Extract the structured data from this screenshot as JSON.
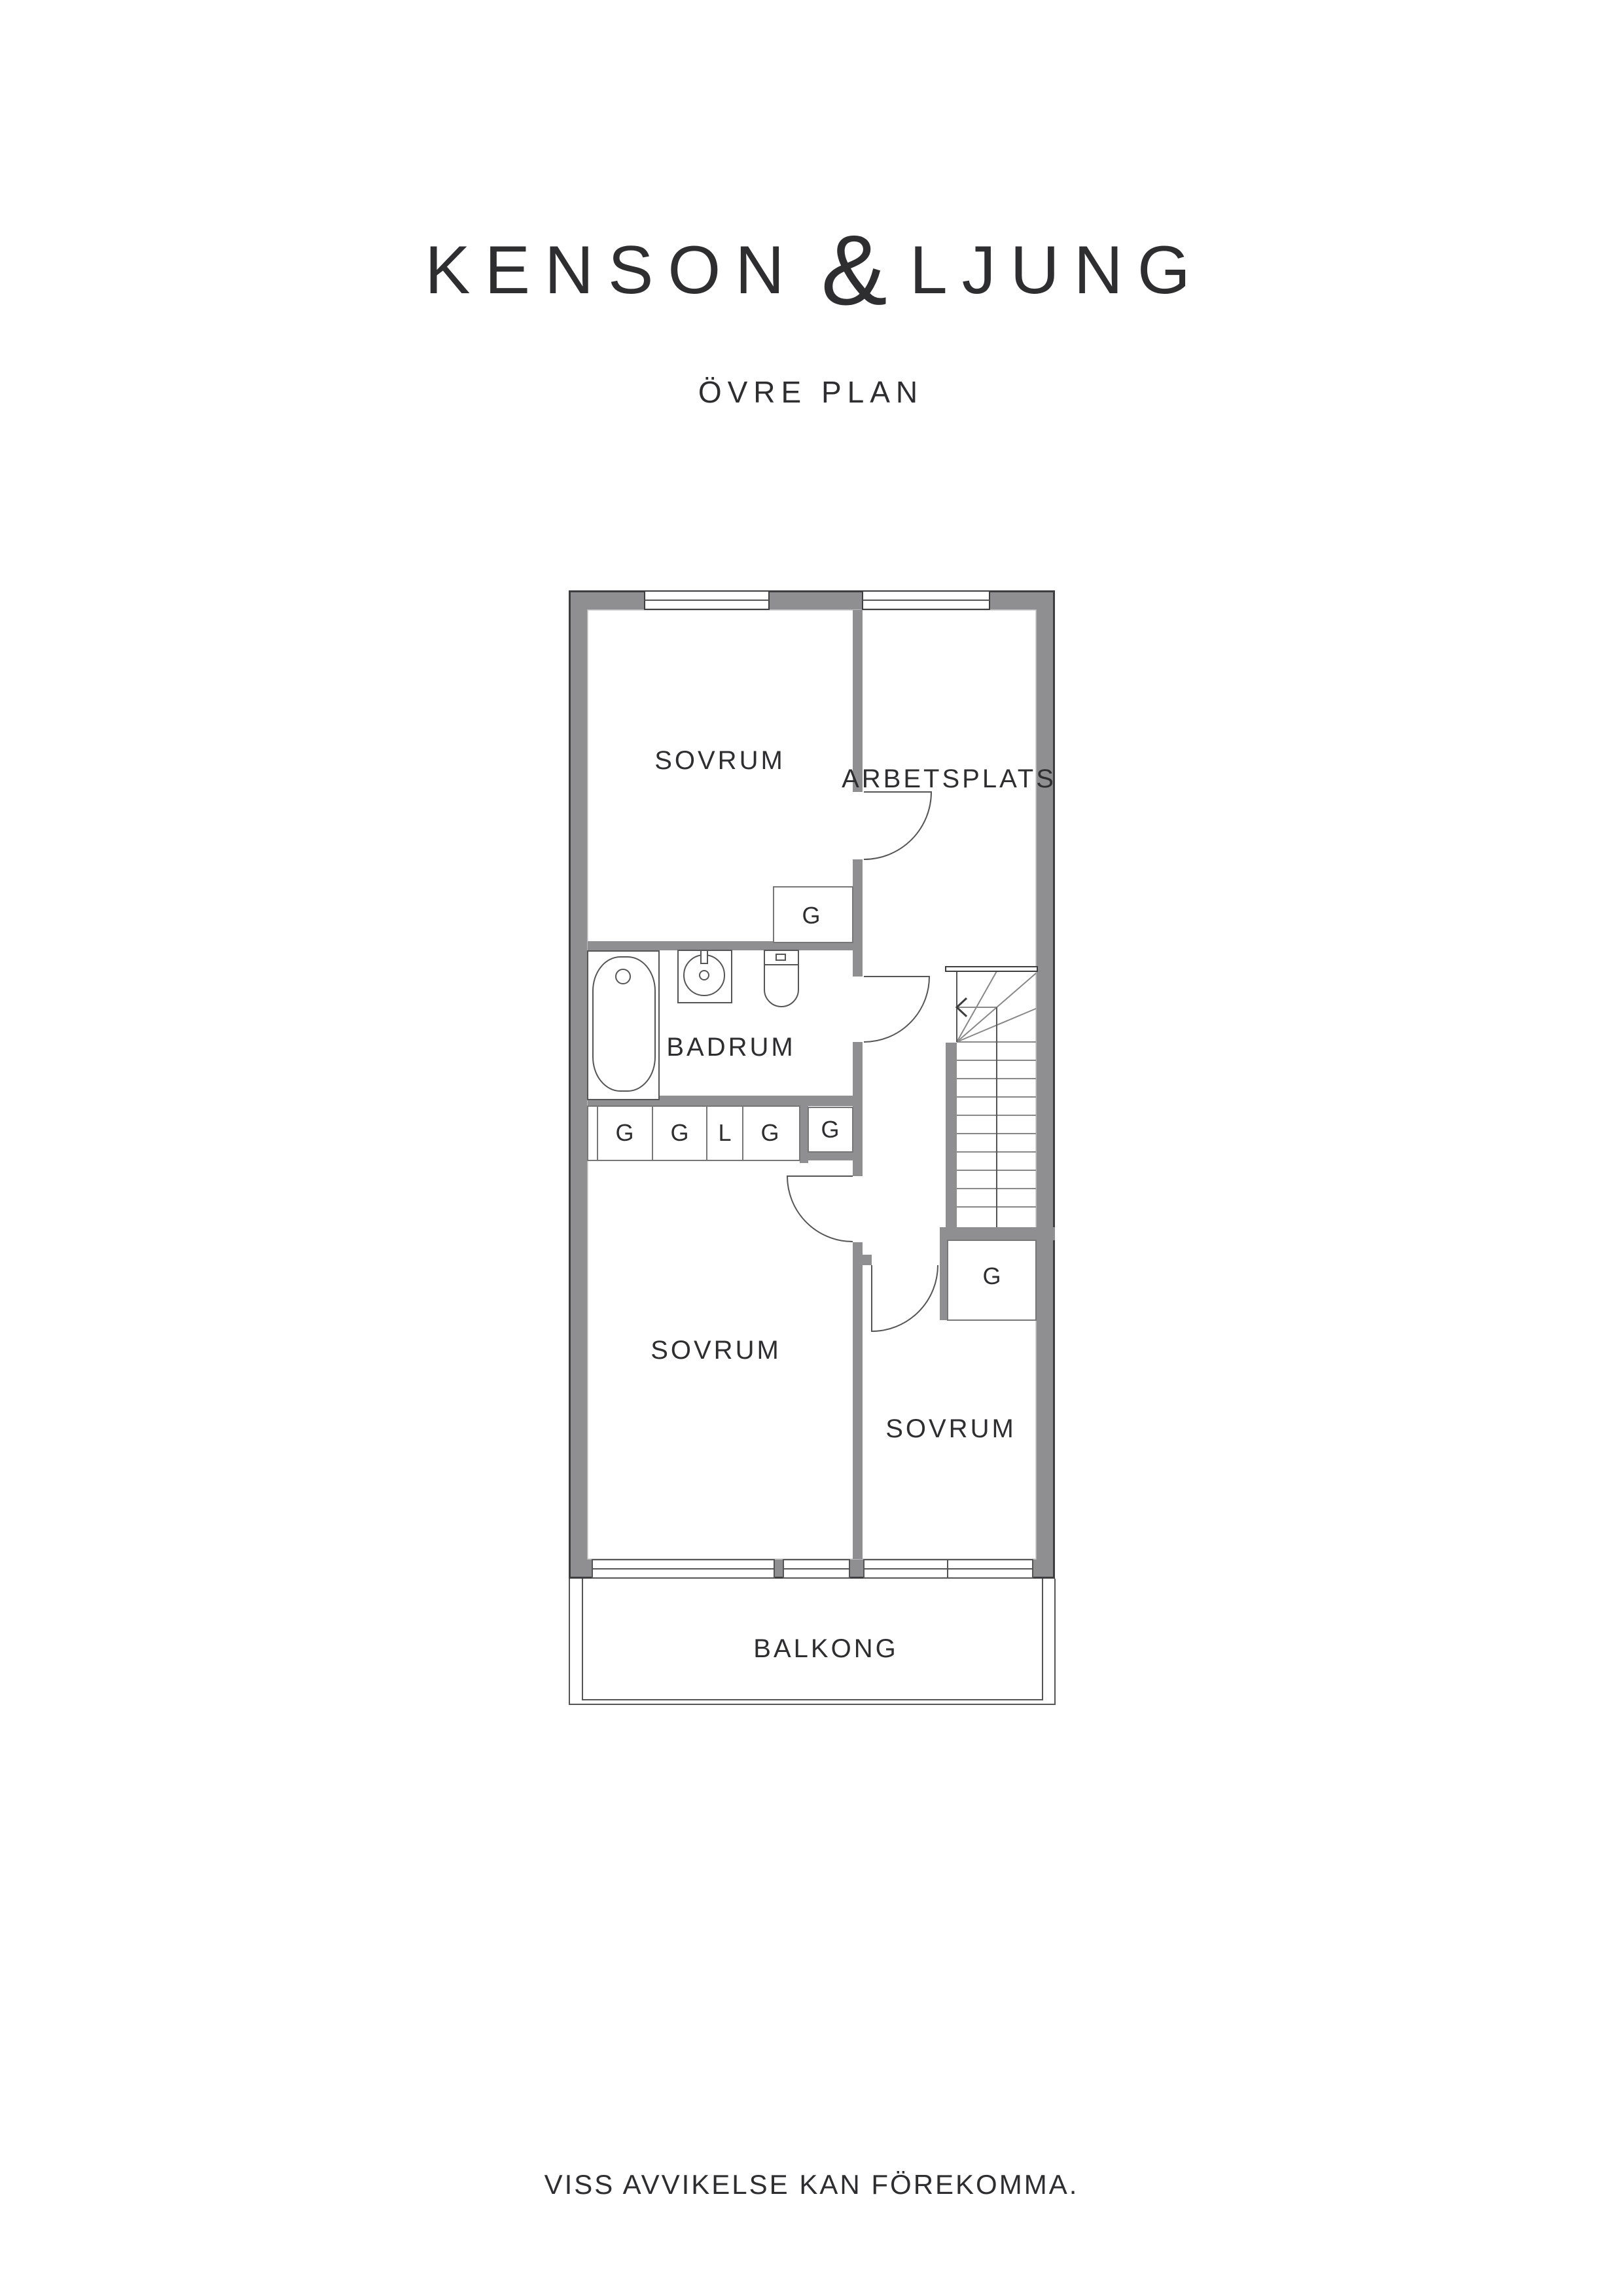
{
  "header": {
    "brand_left": "KENSON",
    "brand_amp": "&",
    "brand_right": "LJUNG",
    "subtitle": "ÖVRE PLAN"
  },
  "plan": {
    "rooms": {
      "sovrum_top": "SOVRUM",
      "arbetsplats": "ARBETSPLATS",
      "badrum": "BADRUM",
      "sovrum_lower_left": "SOVRUM",
      "sovrum_lower_right": "SOVRUM",
      "balkong": "BALKONG"
    },
    "closets": {
      "top": "G",
      "row": [
        "G",
        "G",
        "L",
        "G"
      ],
      "hall": "G",
      "stairs": "G"
    }
  },
  "footer": {
    "disclaimer": "VISS AVVIKELSE KAN FÖREKOMMA."
  },
  "colors": {
    "wall": "#8f8f91",
    "outline": "#3e3e40",
    "line": "#555555",
    "light_line": "#888888",
    "text": "#2e2e30"
  }
}
